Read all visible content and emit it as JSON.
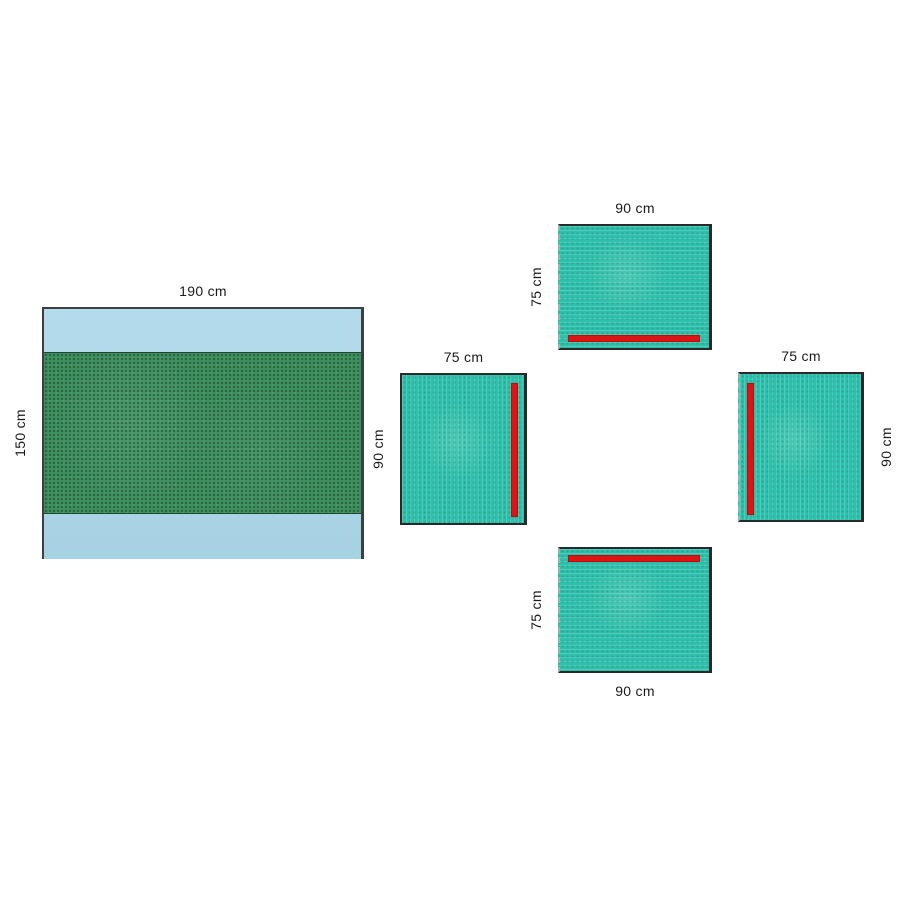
{
  "diagram": {
    "kind": "surgical-drape-set",
    "colors": {
      "table_cover_blue": "#a9d6e8",
      "absorbent_zone_green": "#3f8e5e",
      "drape_teal": "#2fc0ab",
      "adhesive_strip_red": "#dc1414",
      "outline_dark": "#2c2c2c",
      "label_text": "#1a1a1a"
    }
  },
  "drapes": {
    "large": {
      "width_label": "190 cm",
      "height_label": "150 cm",
      "features": "absorbent reinforced center zone"
    },
    "top": {
      "width_label": "90 cm",
      "height_label": "75 cm",
      "adhesive_strip_position": "bottom"
    },
    "left": {
      "width_label": "75 cm",
      "height_label": "90 cm",
      "adhesive_strip_position": "right"
    },
    "right": {
      "width_label": "75 cm",
      "height_label": "90 cm",
      "adhesive_strip_position": "left"
    },
    "bottom": {
      "width_label": "90 cm",
      "height_label": "75 cm",
      "adhesive_strip_position": "top"
    }
  }
}
